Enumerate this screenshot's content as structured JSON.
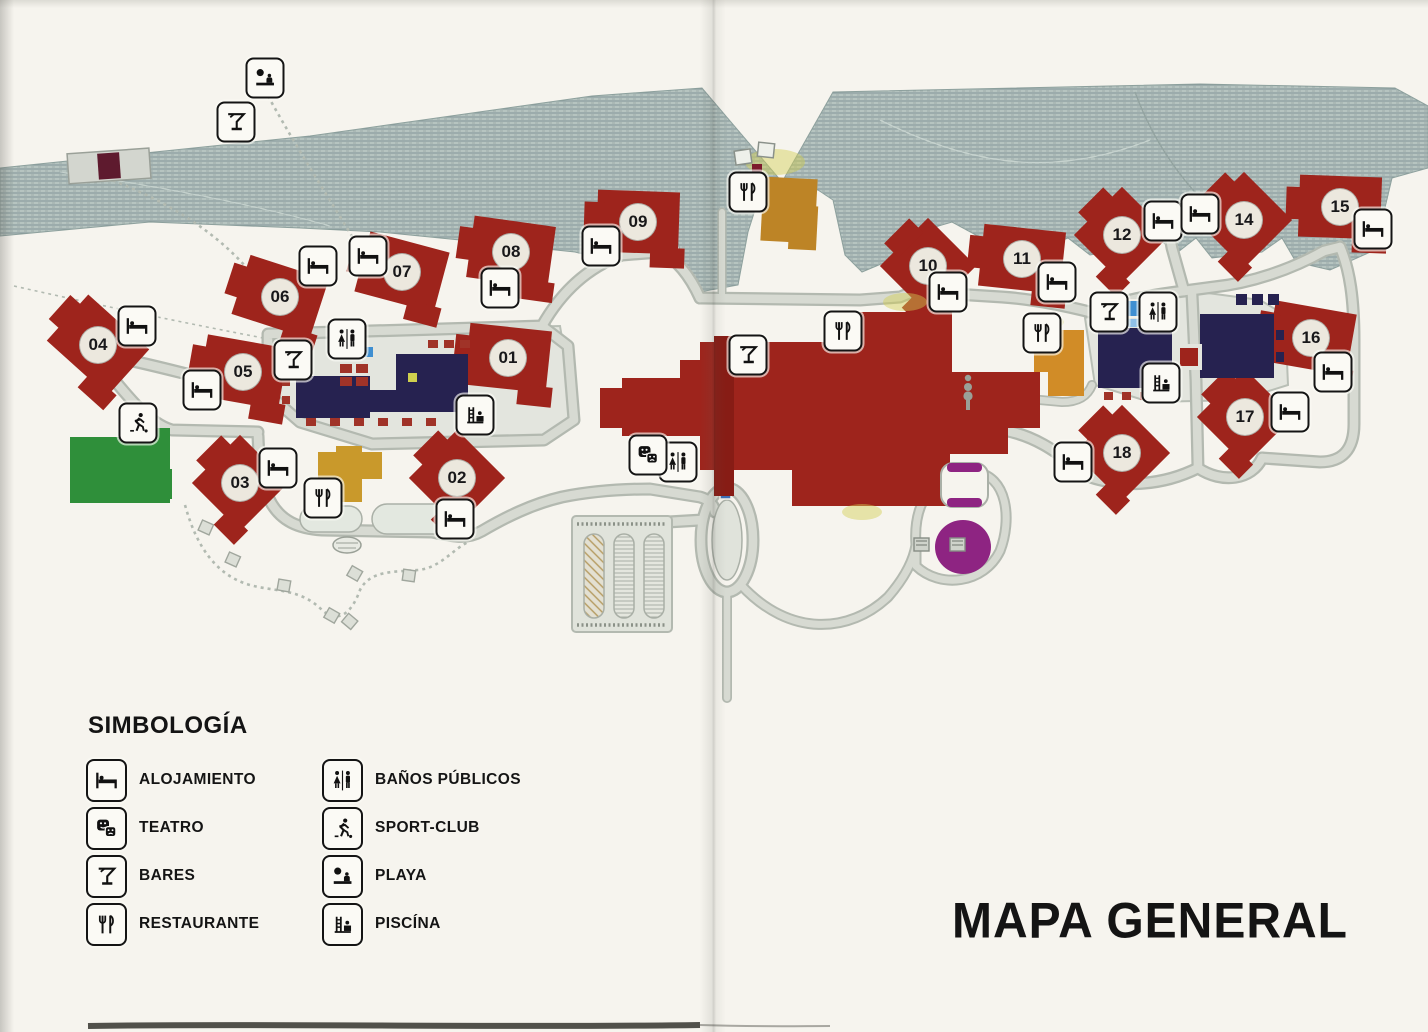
{
  "document": {
    "title": "MAPA GENERAL"
  },
  "legend": {
    "heading": "SIMBOLOGÍA",
    "items": [
      {
        "icon": "bed",
        "label": "ALOJAMIENTO"
      },
      {
        "icon": "theater",
        "label": "TEATRO"
      },
      {
        "icon": "martini",
        "label": "BARES"
      },
      {
        "icon": "fork-knife",
        "label": "RESTAURANTE"
      },
      {
        "icon": "wc",
        "label": "BAÑOS PÚBLICOS"
      },
      {
        "icon": "sport",
        "label": "SPORT-CLUB"
      },
      {
        "icon": "playa",
        "label": "PLAYA"
      },
      {
        "icon": "piscina",
        "label": "PISCÍNA"
      }
    ]
  },
  "map": {
    "palette": {
      "building_red": "#9e241c",
      "complex_navy": "#262250",
      "beach_hatch": "#b4c3bf",
      "road_gray": "#d7dad2",
      "sport_green": "#2f8f3a",
      "pool_blue": "#3f8fd1",
      "accent_orange": "#c98c28",
      "accent_gold": "#c9992b",
      "accent_purple": "#8e2482",
      "paper": "#f6f4ee",
      "ink": "#141414"
    },
    "buildings": [
      {
        "label": "01",
        "x": 508,
        "y": 358,
        "rot": 6
      },
      {
        "label": "02",
        "x": 457,
        "y": 478,
        "rot": 45
      },
      {
        "label": "03",
        "x": 240,
        "y": 483,
        "rot": 45
      },
      {
        "label": "04",
        "x": 98,
        "y": 345,
        "rot": 42
      },
      {
        "label": "05",
        "x": 243,
        "y": 372,
        "rot": 10
      },
      {
        "label": "06",
        "x": 280,
        "y": 297,
        "rot": 18
      },
      {
        "label": "07",
        "x": 402,
        "y": 272,
        "rot": 15
      },
      {
        "label": "08",
        "x": 511,
        "y": 252,
        "rot": 8
      },
      {
        "label": "09",
        "x": 638,
        "y": 222,
        "rot": 2
      },
      {
        "label": "10",
        "x": 928,
        "y": 266,
        "rot": 45
      },
      {
        "label": "11",
        "x": 1022,
        "y": 259,
        "rot": 6
      },
      {
        "label": "12",
        "x": 1122,
        "y": 235,
        "rot": 45
      },
      {
        "label": "14",
        "x": 1244,
        "y": 220,
        "rot": 45
      },
      {
        "label": "15",
        "x": 1340,
        "y": 207,
        "rot": 2
      },
      {
        "label": "16",
        "x": 1311,
        "y": 338,
        "rot": 10
      },
      {
        "label": "17",
        "x": 1245,
        "y": 417,
        "rot": 45
      },
      {
        "label": "18",
        "x": 1122,
        "y": 453,
        "rot": 45
      }
    ],
    "badges": [
      {
        "icon": "playa",
        "x": 265,
        "y": 78
      },
      {
        "icon": "martini",
        "x": 236,
        "y": 122
      },
      {
        "icon": "bed",
        "x": 137,
        "y": 326
      },
      {
        "icon": "bed",
        "x": 202,
        "y": 390
      },
      {
        "icon": "bed",
        "x": 318,
        "y": 266
      },
      {
        "icon": "bed",
        "x": 368,
        "y": 256
      },
      {
        "icon": "bed",
        "x": 500,
        "y": 288
      },
      {
        "icon": "bed",
        "x": 601,
        "y": 246
      },
      {
        "icon": "bed",
        "x": 278,
        "y": 468
      },
      {
        "icon": "bed",
        "x": 455,
        "y": 519
      },
      {
        "icon": "bed",
        "x": 948,
        "y": 292
      },
      {
        "icon": "bed",
        "x": 1057,
        "y": 282
      },
      {
        "icon": "bed",
        "x": 1163,
        "y": 221
      },
      {
        "icon": "bed",
        "x": 1200,
        "y": 214
      },
      {
        "icon": "bed",
        "x": 1373,
        "y": 229
      },
      {
        "icon": "bed",
        "x": 1333,
        "y": 372
      },
      {
        "icon": "bed",
        "x": 1290,
        "y": 412
      },
      {
        "icon": "bed",
        "x": 1073,
        "y": 462
      },
      {
        "icon": "martini",
        "x": 293,
        "y": 360
      },
      {
        "icon": "martini",
        "x": 748,
        "y": 355
      },
      {
        "icon": "martini",
        "x": 1109,
        "y": 312
      },
      {
        "icon": "wc",
        "x": 347,
        "y": 339
      },
      {
        "icon": "wc",
        "x": 678,
        "y": 462
      },
      {
        "icon": "wc",
        "x": 1158,
        "y": 312
      },
      {
        "icon": "fork-knife",
        "x": 323,
        "y": 498
      },
      {
        "icon": "fork-knife",
        "x": 748,
        "y": 192
      },
      {
        "icon": "fork-knife",
        "x": 843,
        "y": 331
      },
      {
        "icon": "fork-knife",
        "x": 1042,
        "y": 333
      },
      {
        "icon": "piscina",
        "x": 475,
        "y": 415
      },
      {
        "icon": "piscina",
        "x": 1161,
        "y": 383
      },
      {
        "icon": "theater",
        "x": 648,
        "y": 455
      },
      {
        "icon": "sport",
        "x": 138,
        "y": 423
      }
    ]
  }
}
